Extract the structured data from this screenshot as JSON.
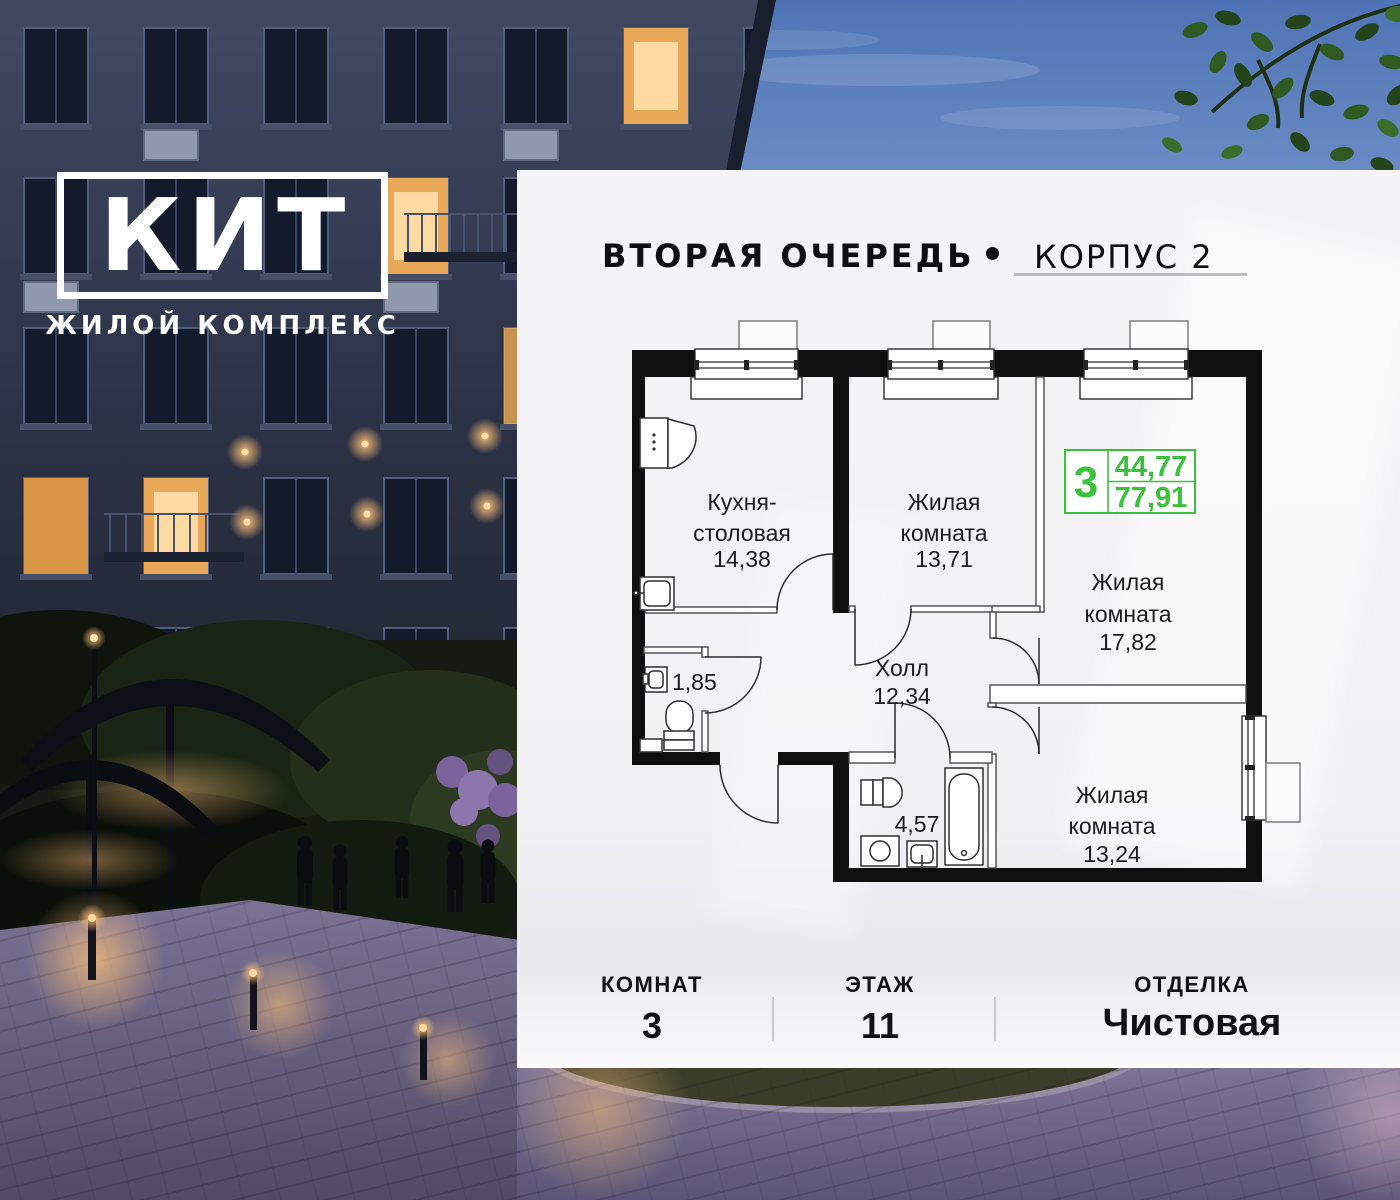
{
  "brand": {
    "name": "КИТ",
    "tagline": "ЖИЛОЙ КОМПЛЕКС"
  },
  "header": {
    "phase": "ВТОРАЯ ОЧЕРЕДЬ",
    "bullet": "•",
    "korpus": "КОРПУС 2"
  },
  "plan": {
    "badge": {
      "rooms_count": "3",
      "living_area": "44,77",
      "total_area": "77,91"
    },
    "rooms": {
      "kitchen": {
        "line1": "Кухня-",
        "line2": "столовая",
        "area": "14,38"
      },
      "living1": {
        "line1": "Жилая",
        "line2": "комната",
        "area": "13,71"
      },
      "living2": {
        "line1": "Жилая",
        "line2": "комната",
        "area": "17,82"
      },
      "hall": {
        "line1": "Холл",
        "area": "12,34"
      },
      "wc": {
        "area": "1,85"
      },
      "bathroom": {
        "area": "4,57"
      },
      "living3": {
        "line1": "Жилая",
        "line2": "комната",
        "area": "13,24"
      }
    }
  },
  "footer": {
    "items": [
      {
        "label": "КОМНАТ",
        "value": "3"
      },
      {
        "label": "ЭТАЖ",
        "value": "11"
      },
      {
        "label": "ОТДЕЛКА",
        "value": "Чистовая"
      }
    ]
  },
  "colors": {
    "accent_green": "#3bc13b",
    "underline_gray": "#bdbdc1",
    "text": "#101010"
  }
}
